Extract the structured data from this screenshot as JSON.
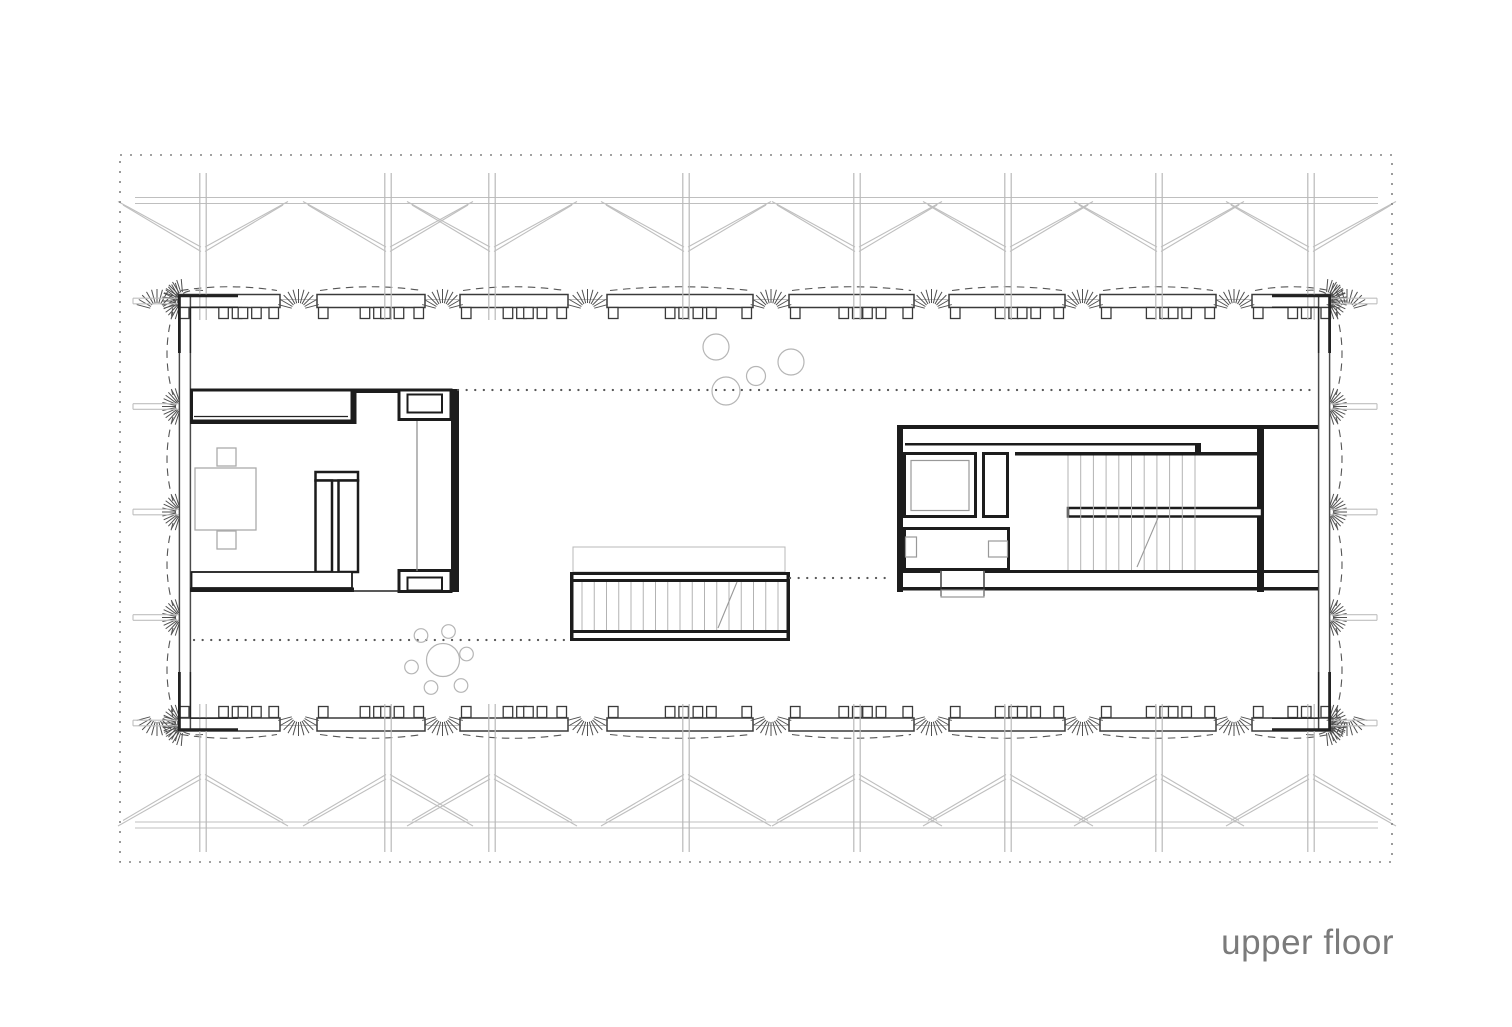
{
  "title": {
    "text": "upper floor",
    "color": "#7b7b7b"
  },
  "canvas": {
    "width": 1512,
    "height": 1027,
    "background": "#ffffff"
  },
  "palette": {
    "structure": "#bfbfbf",
    "column": "#b9b9b9",
    "wall": "#4a4a4a",
    "wall_dark": "#1c1c1c",
    "window": "#3a3a3a",
    "hatch": "#4f4f4f",
    "dashed_arc": "#555555",
    "dotted": "#575757",
    "furniture": "#ababab",
    "tread": "#b3b3b3",
    "site_border": "#828282",
    "plant": "#b5b5b5",
    "thin_gray": "#8a8a8a"
  },
  "site_border": {
    "x": 120,
    "y": 155,
    "w": 1272,
    "h": 707
  },
  "structure": {
    "columns_x": [
      203,
      388,
      492,
      686,
      857,
      1008,
      1159,
      1311
    ],
    "beam_x1": 135,
    "beam_x2": 1378,
    "top": {
      "beam_y": 200.5,
      "col_y1": 173,
      "col_y2": 320,
      "attach_y": 247
    },
    "bottom": {
      "beam_y": 825,
      "col_y1": 704,
      "col_y2": 852,
      "attach_y": 779
    },
    "brace_reach": 85,
    "stub_levels": [
      301,
      406.5,
      512,
      617.5,
      723
    ],
    "stub_left": [
      133,
      179
    ],
    "stub_right": [
      1330,
      1377
    ]
  },
  "building": {
    "left_wall_x": [
      179.4,
      190.4
    ],
    "right_wall_x": [
      1318.6,
      1329.6
    ],
    "wall_y1": 295.8,
    "wall_y2": 729.7,
    "sill_top_y": 299.5,
    "sill_bottom_y": 725.5,
    "win_top": {
      "y": 294.5,
      "h": 13,
      "mull_y": 307.5,
      "mull_h": 11
    },
    "win_bottom": {
      "y": 718,
      "h": 13,
      "mull_y": 706.5,
      "mull_h": 11
    },
    "window_spans": [
      [
        178,
        280
      ],
      [
        317,
        425
      ],
      [
        460,
        568
      ],
      [
        607,
        753
      ],
      [
        789,
        914
      ],
      [
        949,
        1065
      ],
      [
        1100,
        1216
      ],
      [
        1252,
        1332
      ]
    ]
  },
  "hatch": {
    "gap_centers": [
      157,
      298.5,
      442.5,
      587.5,
      771,
      931.5,
      1082.5,
      1234,
      1347
    ],
    "side_levels": [
      301,
      406.5,
      512,
      617.5,
      723
    ],
    "side_bays": [
      [
        306,
        401
      ],
      [
        411,
        507
      ],
      [
        517,
        612
      ],
      [
        622,
        718
      ]
    ]
  },
  "interior_dotted": [
    [
      458,
      390,
      1313,
      390
    ],
    [
      790,
      578,
      893,
      578
    ],
    [
      194,
      640,
      570,
      640
    ]
  ],
  "plants": {
    "circles": [
      [
        716,
        347,
        13
      ],
      [
        791,
        362,
        13
      ],
      [
        756,
        376,
        9.5
      ],
      [
        726,
        391,
        14
      ]
    ]
  },
  "round_table": {
    "table": [
      443,
      660,
      16.5
    ],
    "chairs_r": 6.8,
    "chairs": [
      [
        421,
        635.5
      ],
      [
        448.5,
        631.5
      ],
      [
        466.5,
        654
      ],
      [
        411.5,
        667
      ],
      [
        431,
        687.5
      ],
      [
        461,
        685.5
      ]
    ]
  },
  "left_block": {
    "fills": [
      [
        352,
        388.5,
        47,
        4.5
      ],
      [
        349.5,
        390,
        7,
        34
      ],
      [
        451,
        389,
        8,
        203
      ],
      [
        190,
        419.5,
        164,
        4.5
      ],
      [
        190,
        587.5,
        164,
        4.5
      ]
    ],
    "boxes": [
      [
        191.5,
        390,
        160.5,
        31,
        3
      ],
      [
        399,
        390,
        52,
        29.5,
        3
      ],
      [
        407.5,
        394.5,
        34.5,
        18,
        2
      ],
      [
        315.5,
        472,
        42.5,
        8.5,
        2.5
      ],
      [
        315.5,
        480.5,
        16.5,
        91.5,
        2.5
      ],
      [
        338.5,
        480.5,
        19.5,
        91.5,
        2.5
      ],
      [
        191.5,
        572,
        160.5,
        16,
        1.8
      ],
      [
        399,
        570.5,
        52,
        21,
        3
      ],
      [
        407.5,
        577.5,
        34.5,
        13,
        2
      ]
    ],
    "lines": [
      [
        194,
        416.5,
        348,
        416.5,
        1.2
      ],
      [
        352,
        591,
        399,
        591,
        1.5
      ]
    ],
    "thin_vertical": [
      417,
      421,
      417,
      571
    ],
    "furniture": [
      [
        195,
        468,
        61,
        62
      ],
      [
        217,
        448,
        19,
        18
      ],
      [
        217,
        531,
        19,
        18
      ]
    ]
  },
  "right_block": {
    "fills": [
      [
        897,
        425,
        421,
        4
      ],
      [
        905,
        443,
        290,
        2.5
      ],
      [
        897,
        429,
        6,
        163
      ],
      [
        1015,
        452,
        249,
        3.5
      ],
      [
        1195,
        443,
        6,
        12
      ],
      [
        1257,
        429,
        7,
        163
      ],
      [
        897,
        570,
        43,
        3
      ],
      [
        985,
        570,
        333,
        3
      ],
      [
        897,
        587,
        421,
        3.5
      ]
    ],
    "boxes": [
      [
        904.5,
        453.5,
        71,
        63,
        3
      ],
      [
        983.5,
        453.5,
        24,
        63,
        3
      ],
      [
        904.5,
        528.5,
        104,
        41,
        3
      ],
      [
        1068,
        508,
        194,
        8.5,
        2.5
      ]
    ],
    "elevator_inner": [
      911,
      460.5,
      58,
      50
    ],
    "fixtures": [
      [
        905.5,
        537,
        11,
        20
      ],
      [
        988.5,
        541,
        19,
        16
      ]
    ],
    "door_jambs": [
      [
        941,
        570,
        941,
        596
      ],
      [
        984,
        570,
        984,
        596
      ]
    ],
    "threshold": [
      941,
      590,
      43,
      7
    ],
    "stair": {
      "x1": 1068,
      "x2": 1195,
      "y1": 455.5,
      "y2": 570,
      "steps": 11,
      "diag": [
        1137,
        567,
        1158,
        518
      ]
    }
  },
  "center_stair": {
    "void": [
      573,
      547,
      212,
      25
    ],
    "rails": [
      [
        570,
        572,
        220,
        3
      ],
      [
        570,
        579,
        220,
        3
      ],
      [
        570,
        630,
        220,
        3
      ],
      [
        570,
        638,
        220,
        3
      ]
    ],
    "caps": [
      [
        570,
        572,
        3.5,
        69
      ],
      [
        786.5,
        572,
        3.5,
        69
      ]
    ],
    "treads": {
      "x1": 582,
      "x2": 778,
      "y1": 582,
      "y2": 630,
      "steps": 17
    },
    "diag": [
      718,
      628,
      737,
      582
    ]
  },
  "corners": {
    "outer": [
      "M238,295.8 L179.4,295.8 L179.4,353",
      "M1272,295.8 L1329.6,295.8 L1329.6,353",
      "M238,729.7 L179.4,729.7 L179.4,672",
      "M1272,729.7 L1329.6,729.7 L1329.6,672"
    ],
    "inner": [
      "M238,307.2 L190.4,307.2 L190.4,353",
      "M1272,307.2 L1318.6,307.2 L1318.6,353",
      "M238,718.2 L190.4,718.2 L190.4,672",
      "M1272,718.2 L1318.6,718.2 L1318.6,672"
    ],
    "arcs": [
      "M203,290.5 Q174,287 171.5,316",
      "M1306,290.5 Q1335,287 1337.5,316",
      "M203,734.5 Q174,738 171.5,709",
      "M1306,734.5 Q1335,738 1337.5,709"
    ]
  }
}
